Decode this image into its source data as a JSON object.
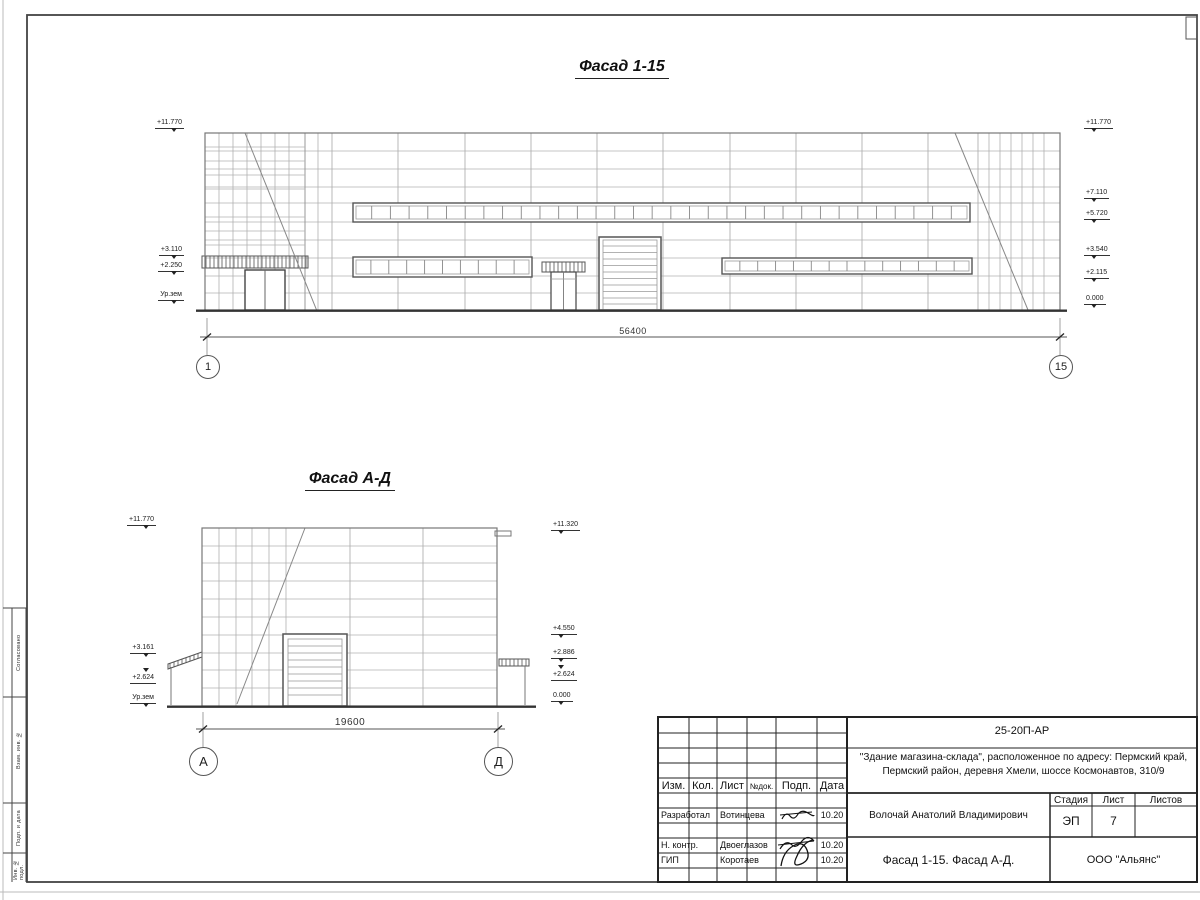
{
  "titles": {
    "facade1": "Фасад 1-15",
    "facade2": "Фасад А-Д"
  },
  "facade1": {
    "levels_left": [
      "+11.770",
      "+3.110",
      "+2.250",
      "Ур.зем"
    ],
    "levels_right": [
      "+11.770",
      "+7.110",
      "+5.720",
      "+3.540",
      "+2.115",
      "0.000"
    ],
    "dimension": "56400",
    "axis_left": "1",
    "axis_right": "15"
  },
  "facade2": {
    "levels_left": [
      "+11.770",
      "+3.161",
      "+2.624",
      "Ур.зем"
    ],
    "levels_right": [
      "+11.320",
      "+4.550",
      "+2.886",
      "+2.624",
      "0.000"
    ],
    "dimension": "19600",
    "axis_left": "А",
    "axis_right": "Д"
  },
  "side_column": {
    "labels": [
      "Согласовано",
      "Взам. инв. №",
      "Подп. и дата",
      "Инв. № подл."
    ]
  },
  "title_block": {
    "document_code": "25-20П-АР",
    "project_line1": "\"Здание магазина-склада\", расположенное по адресу: Пермский край,",
    "project_line2": "Пермский район, деревня Хмели, шоссе Космонавтов, 310/9",
    "columns": [
      "Изм.",
      "Кол.",
      "Лист",
      "№док.",
      "Подп.",
      "Дата"
    ],
    "rows": [
      {
        "role": "Разработал",
        "name": "Вотинцева",
        "date": "10.20"
      },
      {
        "role": "Н. контр.",
        "name": "Двоеглазов",
        "date": "10.20"
      },
      {
        "role": "ГИП",
        "name": "Коротаев",
        "date": "10.20"
      }
    ],
    "chief_name": "Волочай Анатолий Владимирович",
    "stage_label": "Стадия",
    "sheet_label": "Лист",
    "sheets_label": "Листов",
    "stage_value": "ЭП",
    "sheet_value": "7",
    "sheets_value": "",
    "drawing_title": "Фасад 1-15. Фасад А-Д.",
    "company": "ООО \"Альянс\""
  }
}
